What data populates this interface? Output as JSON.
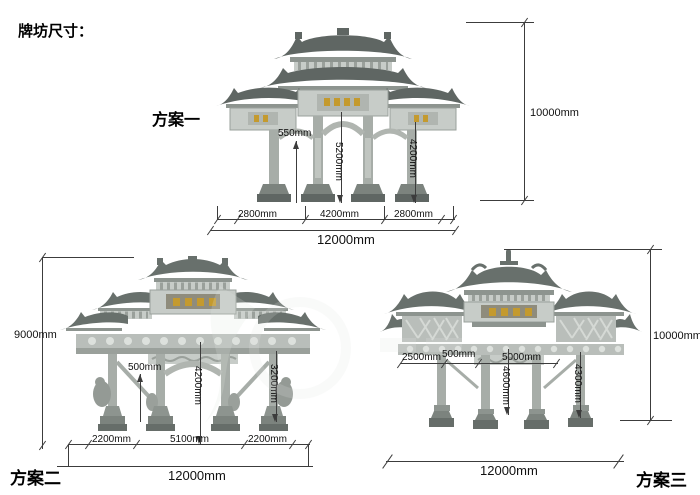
{
  "title": "牌坊尺寸：",
  "plans": {
    "one": {
      "label": "方案一",
      "dims": {
        "plaque_height": "550mm",
        "center_clear": "5200mm",
        "side_clear": "4200mm",
        "total_height": "10000mm",
        "bay_left": "2800mm",
        "bay_center": "4200mm",
        "bay_right": "2800mm",
        "total_width": "12000mm"
      }
    },
    "two": {
      "label": "方案二",
      "dims": {
        "total_height": "9000mm",
        "column_width": "500mm",
        "center_clear": "4200mm",
        "side_clear": "3200mm",
        "bay_left": "2200mm",
        "bay_center": "5100mm",
        "bay_right": "2200mm",
        "total_width": "12000mm"
      }
    },
    "three": {
      "label": "方案三",
      "dims": {
        "total_height": "10000mm",
        "side_bay": "2500mm",
        "column_width": "500mm",
        "center_span": "5000mm",
        "center_clear": "4600mm",
        "side_clear": "4300mm",
        "total_width": "12000mm"
      }
    }
  }
}
